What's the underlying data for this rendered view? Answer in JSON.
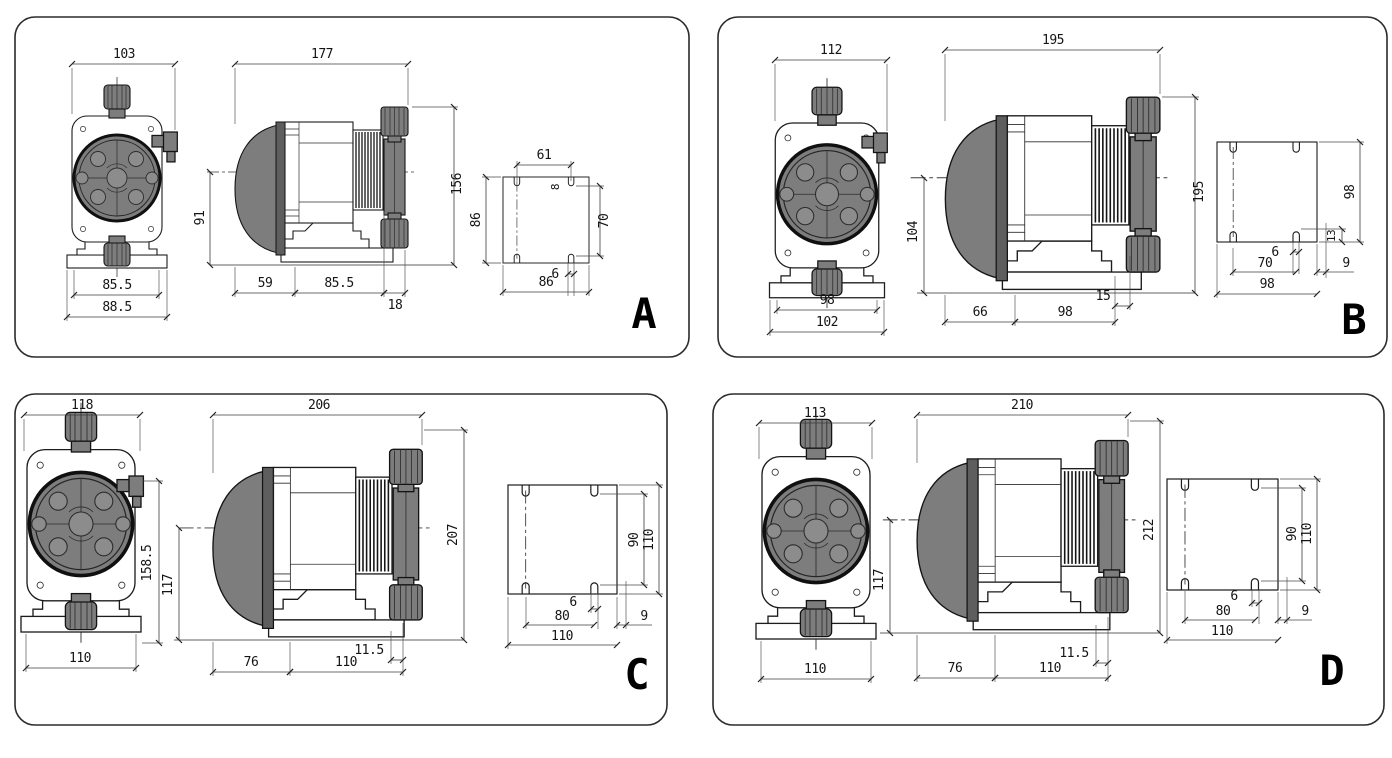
{
  "page": {
    "background": "#ffffff",
    "colors": {
      "pump_gray": "#7d7d7d",
      "pump_gray_dark": "#5e5e5e",
      "line": "#1c1c1c"
    }
  },
  "panels": [
    {
      "label": "A",
      "dims": {
        "front_width": "103",
        "front_base": "85.5",
        "front_base_outer": "88.5",
        "side_length": "177",
        "side_height": "156",
        "side_center_to_base": "91",
        "side_bottom_left": "59",
        "side_bottom_mid": "85.5",
        "side_bottom_right": "18",
        "plate_slot_span_top": "61",
        "plate_slot_width_top": "8",
        "plate_height_left": "86",
        "plate_slot_span_side": "70",
        "plate_slot_width_bottom": "6",
        "plate_width_bottom": "86"
      }
    },
    {
      "label": "B",
      "dims": {
        "front_width": "112",
        "front_base": "98",
        "front_base_outer": "102",
        "side_length": "195",
        "side_height": "195",
        "side_center_to_base": "104",
        "side_bottom_left": "66",
        "side_bottom_mid": "98",
        "side_bottom_right": "15",
        "plate_height_right": "98",
        "plate_corner_offset": "13",
        "plate_slot_width_bottom": "6",
        "plate_slot_span_bottom": "70",
        "plate_edge_offset": "9",
        "plate_width_bottom": "98"
      }
    },
    {
      "label": "C",
      "dims": {
        "front_width": "118",
        "front_height": "158.5",
        "front_base": "110",
        "side_length": "206",
        "side_height": "207",
        "side_center_to_base": "117",
        "side_bottom_left": "76",
        "side_bottom_mid": "110",
        "side_bottom_right": "11.5",
        "plate_slot_span_side": "90",
        "plate_height_right": "110",
        "plate_slot_width_bottom": "6",
        "plate_slot_span_bottom": "80",
        "plate_edge_offset": "9",
        "plate_width_bottom": "110"
      }
    },
    {
      "label": "D",
      "dims": {
        "front_width": "113",
        "front_base": "110",
        "side_length": "210",
        "side_height": "212",
        "side_center_to_base": "117",
        "side_bottom_left": "76",
        "side_bottom_mid": "110",
        "side_bottom_right": "11.5",
        "plate_slot_span_side": "90",
        "plate_height_right": "110",
        "plate_slot_width_bottom": "6",
        "plate_slot_span_bottom": "80",
        "plate_edge_offset": "9",
        "plate_width_bottom": "110"
      }
    }
  ]
}
